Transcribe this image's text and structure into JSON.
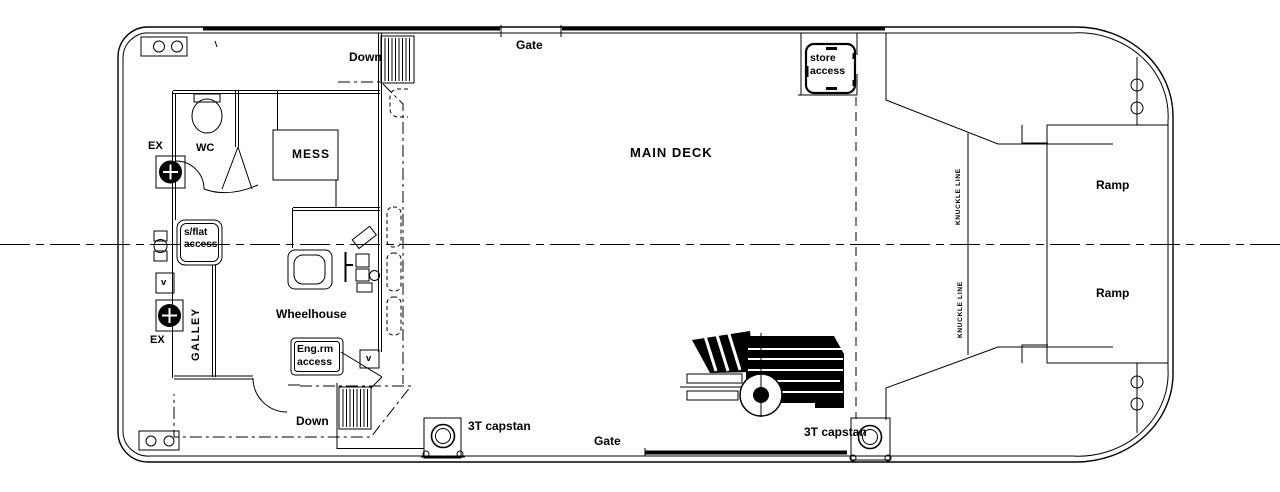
{
  "meta": {
    "drawing_type": "ship main deck general arrangement plan"
  },
  "colors": {
    "background": "#ffffff",
    "line": "#000000"
  },
  "labels": {
    "main_deck": "MAIN DECK",
    "gate_top": "Gate",
    "gate_bottom": "Gate",
    "down_top": "Down",
    "down_bottom": "Down",
    "wc": "WC",
    "mess": "MESS",
    "wheelhouse": "Wheelhouse",
    "galley": "GALLEY",
    "ex_top": "EX",
    "ex_bottom": "EX",
    "vent_top": "v",
    "vent_bottom": "v",
    "store_access_line1": "store",
    "store_access_line2": "access",
    "sflat_access_line1": "s/flat",
    "sflat_access_line2": "access",
    "engrm_access_line1": "Eng.rm",
    "engrm_access_line2": "access",
    "knuckle_line_top": "KNUCKLE LINE",
    "knuckle_line_bottom": "KNUCKLE LINE",
    "ramp_top": "Ramp",
    "ramp_bottom": "Ramp",
    "capstan_left": "3T capstan",
    "capstan_right": "3T capstan"
  }
}
